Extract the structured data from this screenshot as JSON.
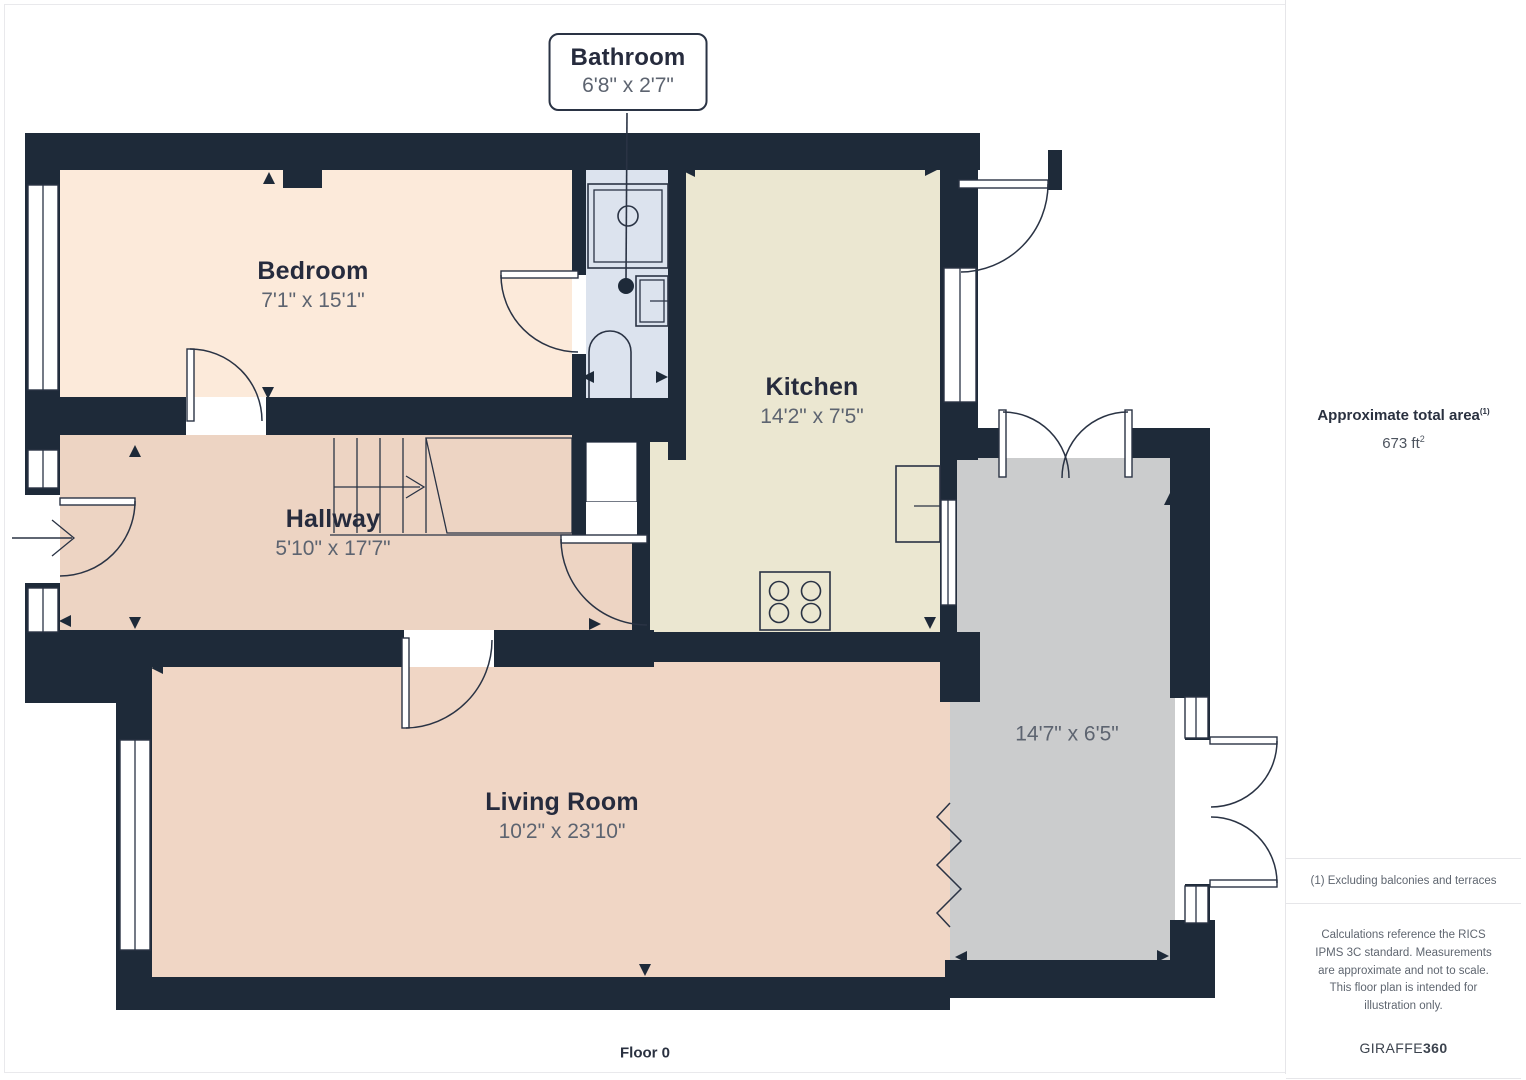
{
  "floor_label": "Floor 0",
  "callout": {
    "name": "Bathroom",
    "dims": "6'8\" x 2'7\""
  },
  "rooms": [
    {
      "id": "bedroom",
      "name": "Bedroom",
      "dims": "7'1\" x 15'1\""
    },
    {
      "id": "kitchen",
      "name": "Kitchen",
      "dims": "14'2\" x 7'5\""
    },
    {
      "id": "hallway",
      "name": "Hallway",
      "dims": "5'10\" x 17'7\""
    },
    {
      "id": "living",
      "name": "Living Room",
      "dims": "10'2\" x 23'10\""
    },
    {
      "id": "extension",
      "name": "",
      "dims": "14'7\" x 6'5\""
    }
  ],
  "sidebar": {
    "area_title": "Approximate total area",
    "area_title_sup": "(1)",
    "area_value": "673 ft",
    "area_value_sup": "2",
    "footnote": "(1) Excluding balconies and terraces",
    "disclaimer": "Calculations reference the RICS IPMS 3C standard. Measurements are approximate and not to scale. This floor plan is intended for illustration only.",
    "brand_regular": "GIRAFFE",
    "brand_bold": "360"
  },
  "colors": {
    "wall": "#1e2a39",
    "outline": "#2a3344",
    "bedroom": "#fceada",
    "bathroom": "#dce3ee",
    "kitchen": "#ebe7d1",
    "hallway": "#edd4c3",
    "living": "#f0d6c5",
    "extension": "#cbcccd",
    "closet": "#c9cacc",
    "label": "#262b3d",
    "dims": "#5d6470"
  }
}
